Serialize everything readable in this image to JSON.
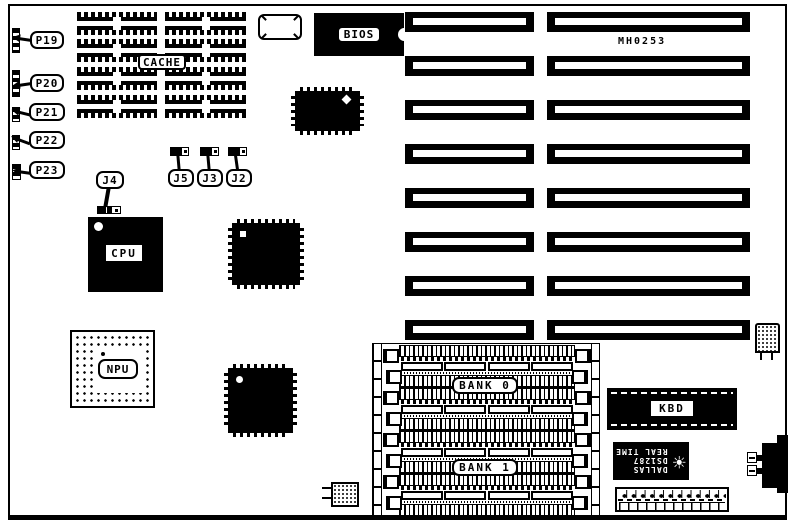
{
  "board": {
    "model_code": "MH0253"
  },
  "connectors": {
    "p19": "P19",
    "p20": "P20",
    "p21": "P21",
    "p22": "P22",
    "p23": "P23"
  },
  "jumpers": {
    "j2": "J2",
    "j3": "J3",
    "j4": "J4",
    "j5": "J5"
  },
  "chips": {
    "cache": "CACHE",
    "bios": "BIOS",
    "cpu": "CPU",
    "npu": "NPU",
    "kbd": "KBD"
  },
  "memory": {
    "bank0": "BANK 0",
    "bank1": "BANK 1"
  },
  "rtc": {
    "brand": "DALLAS",
    "part": "DS1287",
    "type": "REAL TIME",
    "logo_icon": "☀"
  },
  "colors": {
    "ink": "#000000",
    "paper": "#ffffff"
  }
}
